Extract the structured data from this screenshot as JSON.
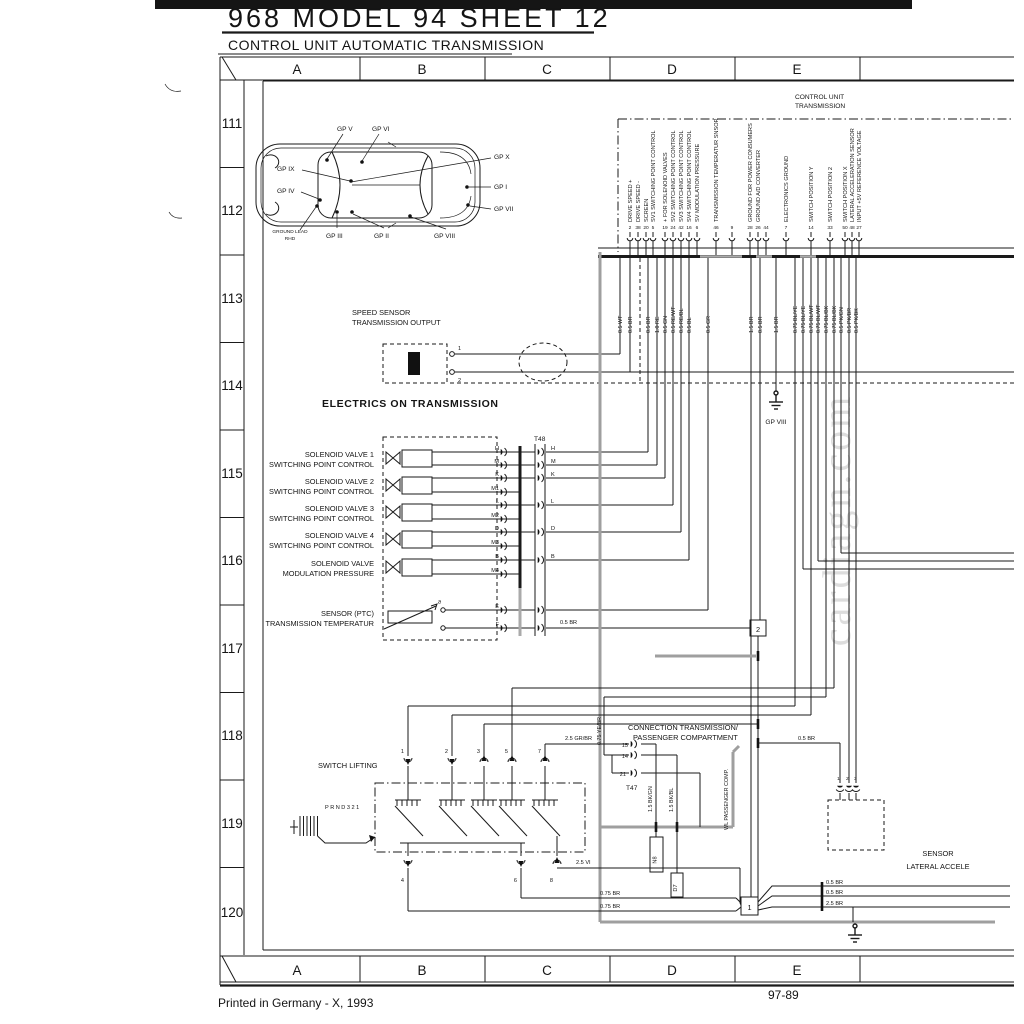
{
  "page": {
    "title": "968  MODEL 94  SHEET 12",
    "subtitle": "CONTROL UNIT AUTOMATIC TRANSMISSION",
    "printed": "Printed in Germany - X, 1993",
    "sheet_no": "97-89",
    "watermark": "cardiagn.com"
  },
  "grid": {
    "cols": [
      "A",
      "B",
      "C",
      "D",
      "E"
    ],
    "rows": [
      "111",
      "112",
      "113",
      "114",
      "115",
      "116",
      "117",
      "118",
      "119",
      "120"
    ]
  },
  "car": {
    "gpv": "GP V",
    "gpvi": "GP VI",
    "gpix": "GP IX",
    "gpiv": "GP IV",
    "gpx": "GP X",
    "gpi": "GP I",
    "gpvii": "GP VII",
    "gl1": "GROUND LEAD",
    "gl2": "RHD",
    "gpiii": "GP III",
    "gpii": "GP II",
    "gpviii": "GP VIII"
  },
  "cu": {
    "t1": "CONTROL UNIT",
    "t2": "TRANSMISSION",
    "pins": [
      {
        "n": "2",
        "l": "DRIVE SPEED +"
      },
      {
        "n": "38",
        "l": "DRIVE SPEED -"
      },
      {
        "n": "20",
        "l": "SCREEN"
      },
      {
        "n": "5",
        "l": "SV1 SWITCHING POINT CONTROL"
      },
      {
        "n": "19",
        "l": "+ FOR SOLENOID VALVES"
      },
      {
        "n": "24",
        "l": "SV2 SWITCHING POINT CONTROL"
      },
      {
        "n": "42",
        "l": "SV3 SWITCHING POINT CONTROL"
      },
      {
        "n": "16",
        "l": "SV4 SWITCHING POINT CONTROL"
      },
      {
        "n": "6",
        "l": "SV MODULATION PRESSURE"
      },
      {
        "n": "46",
        "l": "TRANSMISSION TEMPERATUR SNSOR"
      },
      {
        "n": "9",
        "l": ""
      },
      {
        "n": "28",
        "l": "GROUND FOR POWER CONSUMERS"
      },
      {
        "n": "26",
        "l": "GROUND A/D CONVERTER"
      },
      {
        "n": "44",
        "l": ""
      },
      {
        "n": "7",
        "l": "ELECTRONICS GROUND"
      },
      {
        "n": "14",
        "l": "SWITCH POSITION Y"
      },
      {
        "n": "33",
        "l": "SWITCH POSITION 2"
      },
      {
        "n": "50",
        "l": "SWITCH POSITION X"
      },
      {
        "n": "48",
        "l": "LATERAL ACCELERATION SENSOR"
      },
      {
        "n": "27",
        "l": "INPUT +5V REFERENCE VOLTAGE"
      }
    ]
  },
  "wires": [
    "0.5 WT",
    "0.5 BR",
    "0.5 BR",
    "1.0 RE",
    "0.5 GN",
    "0.5 RE/WT",
    "0.5 RE/BL",
    "0.5 BL",
    "0.5 GR",
    "1.5 BR",
    "0.5 BR",
    "1.5 BR",
    "0.75 BL/YE",
    "0.75 BL/YE",
    "0.75 BL/WT",
    "0.75 BL/WT",
    "0.75 BL/BK",
    "0.75 BL/BK",
    "0.5 PK/GN",
    "0.5 PK/BR",
    "0.5 PK/BK"
  ],
  "valves": [
    {
      "a": "SOLENOID VALVE 1",
      "b": "SWITCHING POINT CONTROL"
    },
    {
      "a": "SOLENOID VALVE 2",
      "b": "SWITCHING POINT CONTROL"
    },
    {
      "a": "SOLENOID VALVE 3",
      "b": "SWITCHING POINT CONTROL"
    },
    {
      "a": "SOLENOID VALVE 4",
      "b": "SWITCHING POINT CONTROL"
    },
    {
      "a": "SOLENOID VALVE",
      "b": "MODULATION PRESSURE"
    },
    {
      "a": "SENSOR (PTC)",
      "b": "TRANSMISSION TEMPERATUR"
    }
  ],
  "t48": {
    "name": "T48",
    "pins": [
      "H",
      "M",
      "K",
      "M1",
      "L",
      "M2",
      "D",
      "M3",
      "B",
      "M4",
      "E",
      "F"
    ]
  },
  "t47": {
    "name": "T47",
    "pins": [
      "15",
      "14",
      "21"
    ]
  },
  "sw": {
    "top": [
      "1",
      "2",
      "3",
      "5",
      "7"
    ],
    "bot": [
      "4",
      "6",
      "8"
    ]
  },
  "sens": {
    "pins": [
      "1",
      "2",
      "3"
    ]
  },
  "speed_pins": [
    "1",
    "2"
  ],
  "labels": {
    "speed1": "SPEED SENSOR",
    "speed2": "TRANSMISSION OUTPUT",
    "electrics": "ELECTRICS ON TRANSMISSION",
    "gpviii": "GP VIII",
    "br05": "0.5 BR",
    "switch": "SWITCH LIFTING",
    "prnd": "PRND321",
    "conn1": "CONNECTION TRANSMISSION/",
    "conn2": "PASSENGER COMPARTMENT",
    "wl": "WL PASSENGER COMP.",
    "bkgn": "1.5 BK/GN",
    "bkbl": "1.5 BK/BL",
    "n8": "N8",
    "d7": "D7",
    "yebr": "0.75 YE/BR",
    "grbr": "2.5 GR/BR",
    "vi": "2.5 VI",
    "br75": "0.75 BR",
    "sbr": "0.5 BR",
    "r1": "0.5 BR",
    "r2": "0.5 BR",
    "r3": "2.5 BR",
    "s1": "1",
    "s2": "2",
    "sensor1": "SENSOR",
    "sensor2": "LATERAL ACCELE"
  }
}
